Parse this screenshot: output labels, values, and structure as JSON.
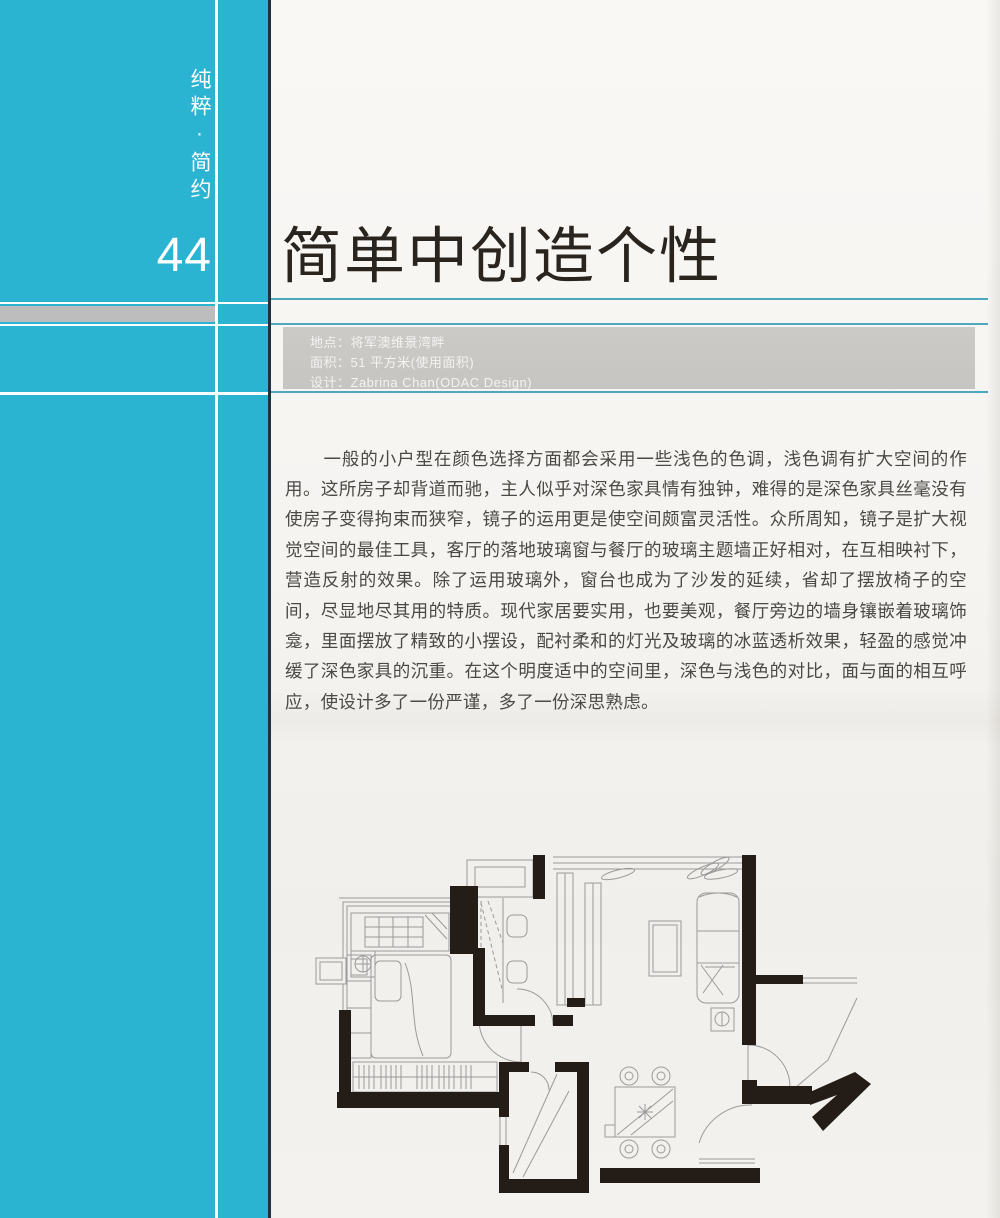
{
  "sidebar": {
    "category": "纯粹·简约",
    "page_number": "44"
  },
  "header": {
    "title": "简单中创造个性"
  },
  "info_bar": {
    "lines": [
      "地点：将军澳维景湾畔",
      "面积：51 平方米(使用面积)",
      "设计：Zabrina Chan(ODAC Design)"
    ]
  },
  "article": {
    "paragraph": "一般的小户型在颜色选择方面都会采用一些浅色的色调，浅色调有扩大空间的作用。这所房子却背道而驰，主人似乎对深色家具情有独钟，难得的是深色家具丝毫没有使房子变得拘束而狭窄，镜子的运用更是使空间颇富灵活性。众所周知，镜子是扩大视觉空间的最佳工具，客厅的落地玻璃窗与餐厅的玻璃主题墙正好相对，在互相映衬下，营造反射的效果。除了运用玻璃外，窗台也成为了沙发的延续，省却了摆放椅子的空间，尽显地尽其用的特质。现代家居要实用，也要美观，餐厅旁边的墙身镶嵌着玻璃饰龛，里面摆放了精致的小摆设，配衬柔和的灯光及玻璃的冰蓝透析效果，轻盈的感觉冲缓了深色家具的沉重。在这个明度适中的空间里，深色与浅色的对比，面与面的相互呼应，使设计多了一份严谨，多了一份深思熟虑。"
  },
  "colors": {
    "sidebar_teal": "#2bb3d2",
    "rule_teal": "#4da8be",
    "info_band_gray": "#c9c7c4",
    "left_band_gray": "#bdbdbd",
    "wall_black": "#241c16",
    "title_color": "#2a241f",
    "body_text_color": "#4b4946"
  }
}
